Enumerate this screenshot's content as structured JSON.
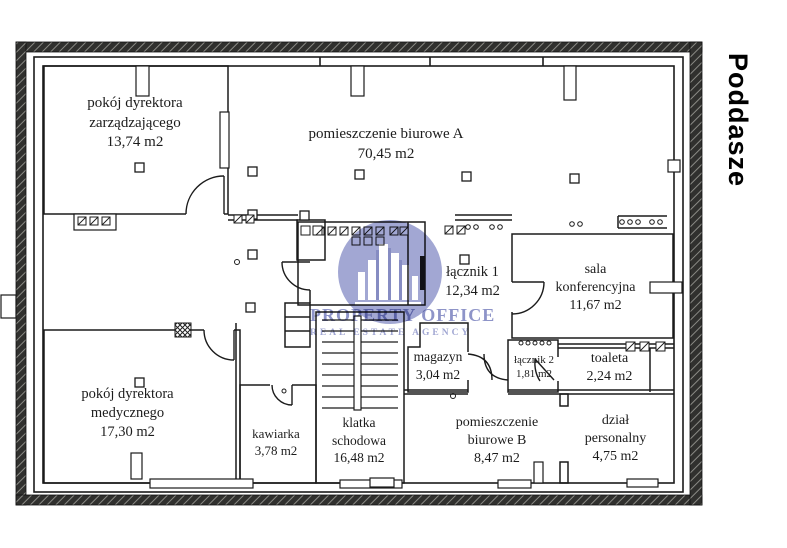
{
  "page_title": "Poddasze",
  "watermark": {
    "line1": "PROPERTY OFFICE",
    "line2": "REAL ESTATE AGENCY",
    "circle_color": "#9aa0d0",
    "text_color": "#8e94c8"
  },
  "rooms": [
    {
      "name": "pokój dyrektora\nzarządzającego",
      "area": "13,74 m2"
    },
    {
      "name": "pomieszczenie biurowe A",
      "area": "70,45 m2"
    },
    {
      "name": "łącznik 1",
      "area": "12,34 m2"
    },
    {
      "name": "sala\nkonferencyjna",
      "area": "11,67 m2"
    },
    {
      "name": "magazyn",
      "area": "3,04 m2"
    },
    {
      "name": "łącznik 2",
      "area": "1,81 m2"
    },
    {
      "name": "toaleta",
      "area": "2,24 m2"
    },
    {
      "name": "pokój dyrektora\nmedycznego",
      "area": "17,30 m2"
    },
    {
      "name": "kawiarka",
      "area": "3,78 m2"
    },
    {
      "name": "klatka\nschodowa",
      "area": "16,48 m2"
    },
    {
      "name": "pomieszczenie\nbiurowe B",
      "area": "8,47 m2"
    },
    {
      "name": "dział\npersonalny",
      "area": "4,75 m2"
    }
  ]
}
